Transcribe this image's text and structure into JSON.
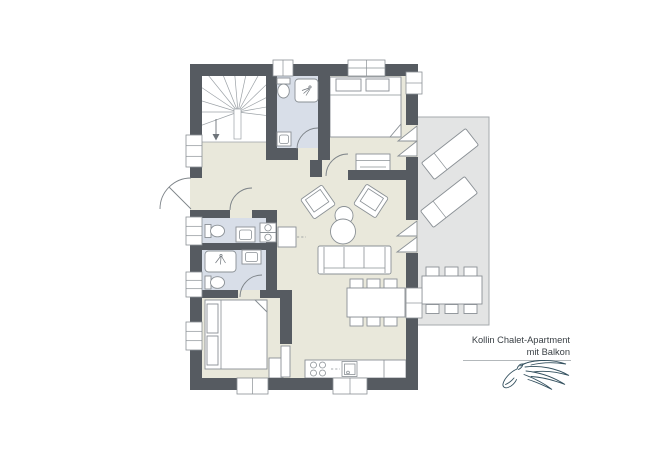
{
  "title": {
    "line1": "Kollin Chalet-Apartment",
    "line2": "mit Balkon"
  },
  "colors": {
    "wall": "#565b61",
    "floor": "#e9e8db",
    "bath": "#d8dee8",
    "balcony": "#e3e4e4",
    "balcony-border": "#a6aaad",
    "line": "#8a9095",
    "fine": "#9ba1a6",
    "text": "#3b4146",
    "logo": "#33505e"
  },
  "icons": {
    "stair_direction": "down-arrow-icon",
    "shower": "shower-spray-icon",
    "brand": "horse-line-art-logo"
  }
}
